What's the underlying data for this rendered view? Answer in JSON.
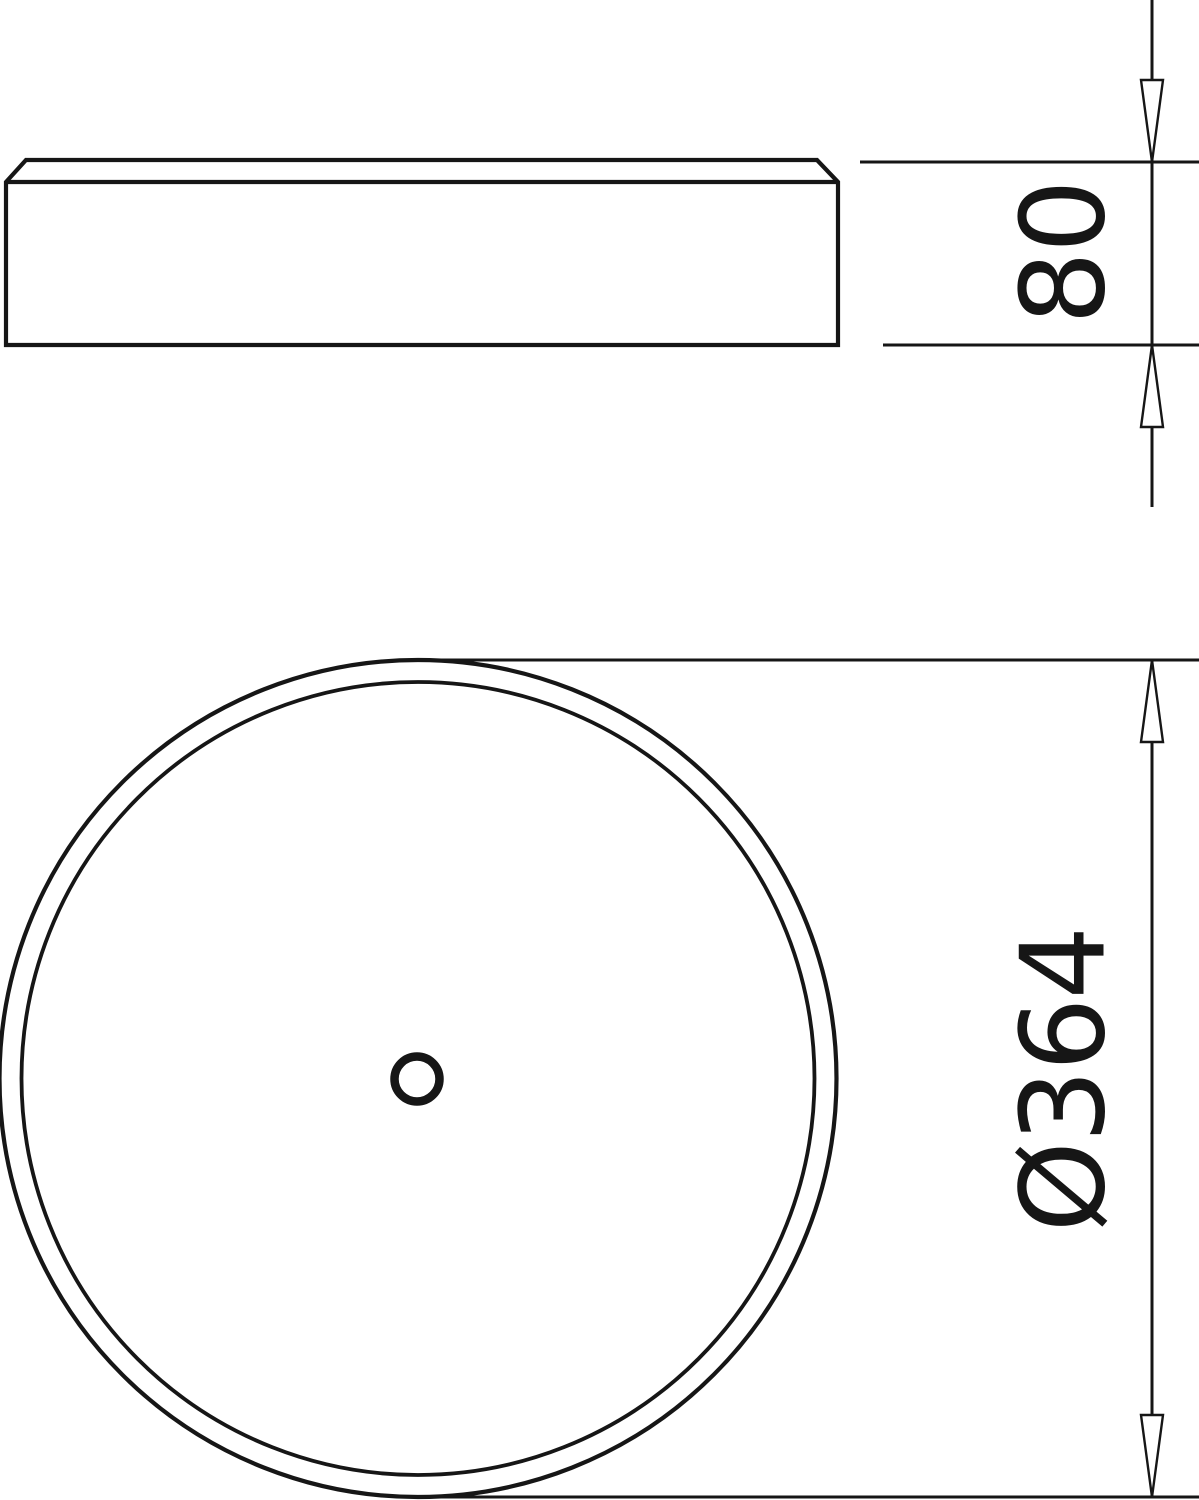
{
  "drawing": {
    "background_color": "#ffffff",
    "line_color": "#161616",
    "dimensions": {
      "height": {
        "label": "80"
      },
      "diameter": {
        "label": "Ø364"
      }
    }
  }
}
